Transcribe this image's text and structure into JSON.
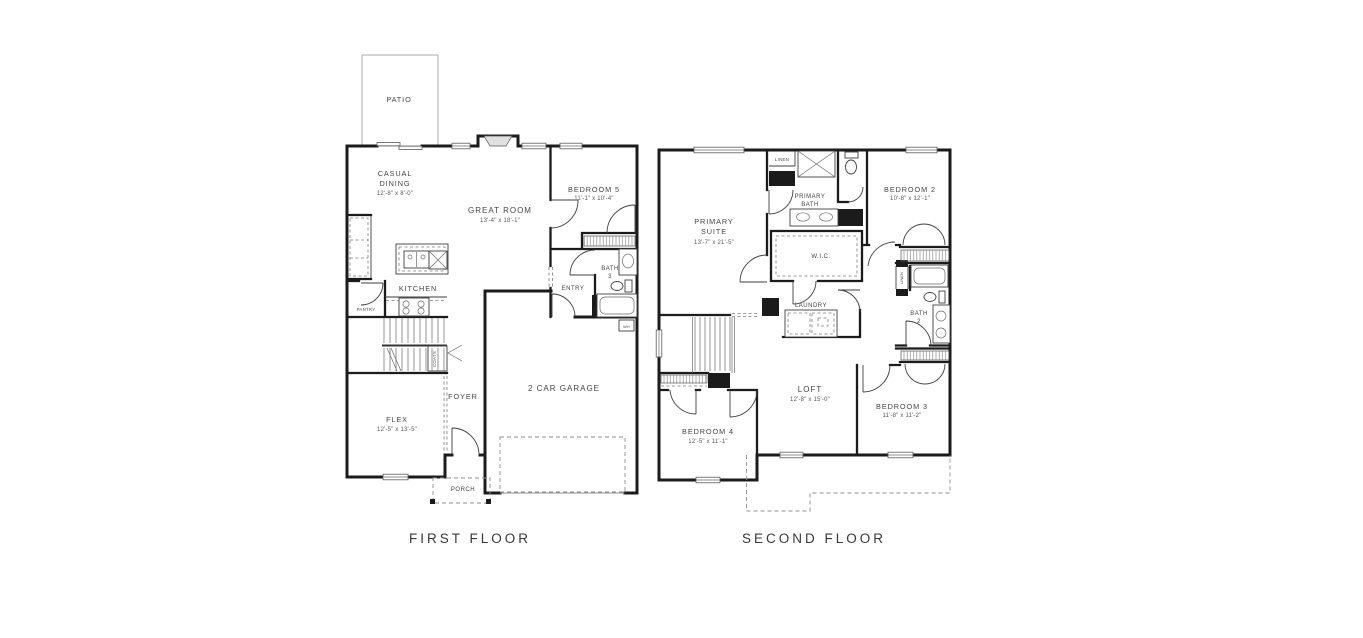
{
  "colors": {
    "wall": "#1b1b1b",
    "text": "#454545",
    "light_line": "#a8a8a8"
  },
  "captions": {
    "first": "FIRST FLOOR",
    "second": "SECOND FLOOR"
  },
  "first_floor": {
    "patio": "PATIO",
    "casual_dining": {
      "line1": "CASUAL",
      "line2": "DINING",
      "dims": "12'-8\" x 8'-0\""
    },
    "great_room": {
      "name": "GREAT ROOM",
      "dims": "13'-4\" x 18'-1\""
    },
    "bedroom5": {
      "name": "BEDROOM 5",
      "dims": "11'-1\" x 10'-4\""
    },
    "kitchen": "KITCHEN",
    "pantry": "PANTRY",
    "coats": "COATS",
    "bath3": {
      "line1": "BATH",
      "line2": "3"
    },
    "entry": "ENTRY",
    "water_heater": "WH",
    "foyer": "FOYER",
    "flex": {
      "name": "FLEX",
      "dims": "12'-5\" x 13'-5\""
    },
    "porch": "PORCH",
    "garage": "2 CAR GARAGE"
  },
  "second_floor": {
    "primary_suite": {
      "line1": "PRIMARY",
      "line2": "SUITE",
      "dims": "13'-7\" x 21'-5\""
    },
    "linen": "LINEN",
    "primary_bath": {
      "line1": "PRIMARY",
      "line2": "BATH"
    },
    "bedroom2": {
      "name": "BEDROOM 2",
      "dims": "10'-8\" x 12'-1\""
    },
    "wic": "W.I.C.",
    "laundry": "LAUNDRY",
    "linen2": "LINEN",
    "bath2": {
      "line1": "BATH",
      "line2": "2"
    },
    "loft": {
      "name": "LOFT",
      "dims": "12'-8\" x 15'-0\""
    },
    "bedroom3": {
      "name": "BEDROOM 3",
      "dims": "11'-8\" x 11'-2\""
    },
    "bedroom4": {
      "name": "BEDROOM 4",
      "dims": "12'-5\" x 11'-1\""
    }
  }
}
